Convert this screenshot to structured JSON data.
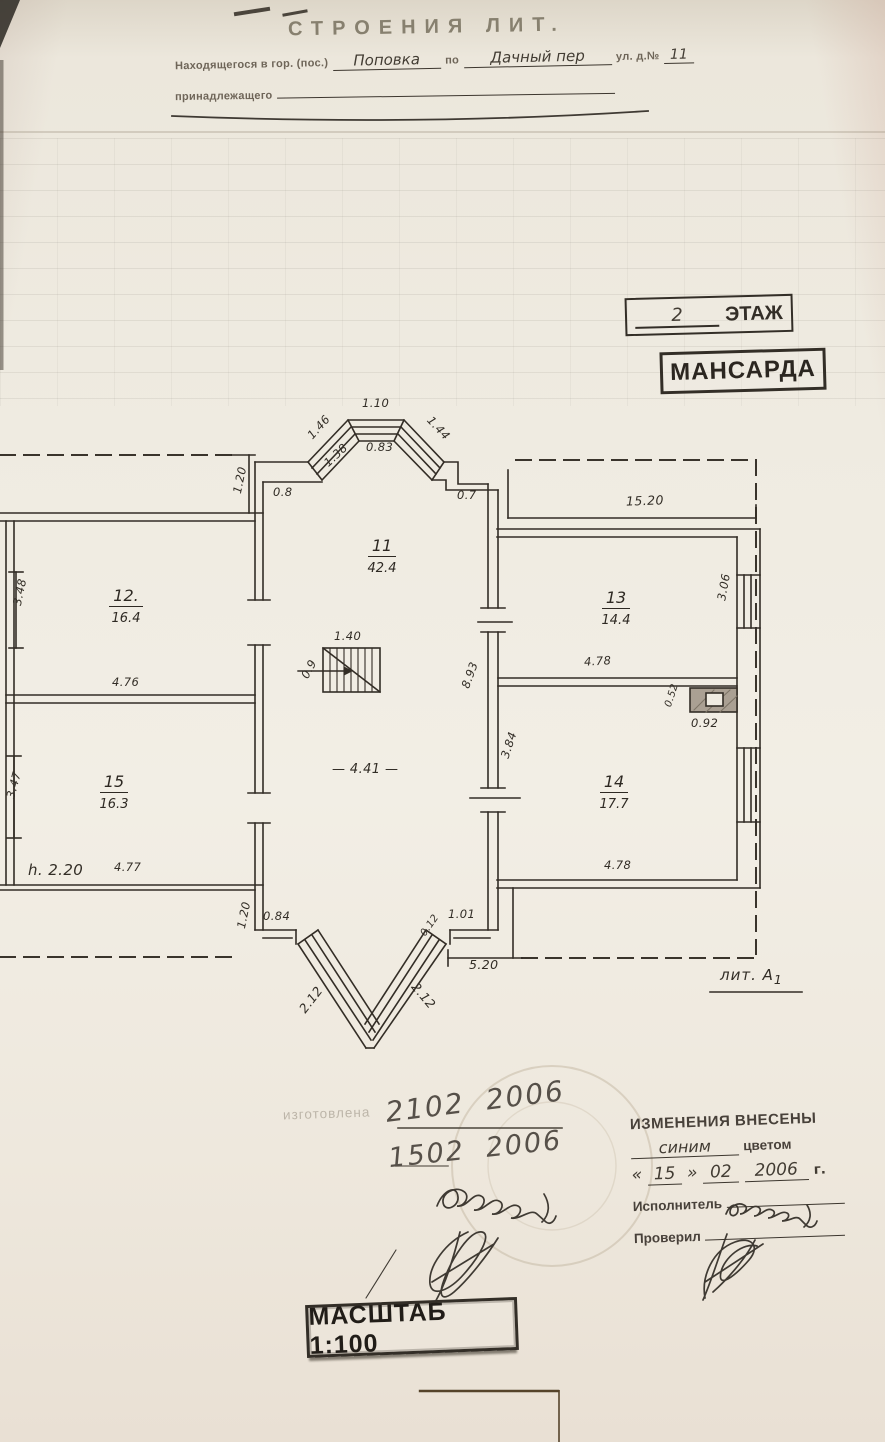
{
  "header": {
    "title": "СТРОЕНИЯ ЛИТ.",
    "located_prefix": "Находящегося в гор. (пос.)",
    "located_fill": "Поповка",
    "located_mid": "по",
    "street_fill": "Дачный пер",
    "street_suffix": "ул. д.№",
    "house_number": "11",
    "owner_label": "принадлежащего"
  },
  "floor_stamp": {
    "number": "2",
    "label": "ЭТАЖ"
  },
  "mansarda_stamp": "МАНСАРДА",
  "plan": {
    "rooms": [
      {
        "num": "11",
        "area": "42.4"
      },
      {
        "num": "12.",
        "area": "16.4"
      },
      {
        "num": "13",
        "area": "14.4"
      },
      {
        "num": "14",
        "area": "17.7"
      },
      {
        "num": "15",
        "area": "16.3"
      }
    ],
    "dims": {
      "bay_top": "1.10",
      "bay_left_outer": "1.46",
      "bay_right_outer": "1.44",
      "bay_left_inner": "1.38",
      "bay_top_inner": "0.83",
      "left_return": "0.8",
      "right_return": "0.7",
      "right_wing_width": "15.20",
      "roof_offset_top": "1.20",
      "roof_offset_bottom": "1.20",
      "room12_depth": "3.48",
      "room15_depth": "3.47",
      "room12_width": "4.76",
      "room15_width": "4.77",
      "stairs_width": "1.40",
      "stairs_depth": "0.9",
      "hall_depth": "8.93",
      "hall_width": "— 4.41 —",
      "hall_lower_depth": "3.84",
      "room13_width": "4.78",
      "room13_depth": "3.06",
      "room14_width": "4.78",
      "stove_width": "0.52",
      "stove_depth": "0.92",
      "height_note": "h. 2.20",
      "bottom_left_step": "0.84",
      "bottom_mid": "0.12",
      "bottom_right_step": "1.01",
      "bottom_width": "5.20",
      "bay2_left": "2.12",
      "bay2_right": "2.12"
    },
    "lit_label": "лит. А",
    "lit_sub": "1"
  },
  "notes": {
    "faint_text": "изготовлена",
    "date1": "2102  2006",
    "date2": "1502  2006"
  },
  "changes_stamp": {
    "title": "ИЗМЕНЕНИЯ ВНЕСЕНЫ",
    "color_fill": "синим",
    "color_suffix": "цветом",
    "quote_l": "«",
    "day": "15",
    "quote_r": "»",
    "month": "02",
    "year": "2006",
    "year_suffix": "г.",
    "executor_label": "Исполнитель",
    "checker_label": "Проверил"
  },
  "scale_stamp": "МАСШТАБ 1:100"
}
